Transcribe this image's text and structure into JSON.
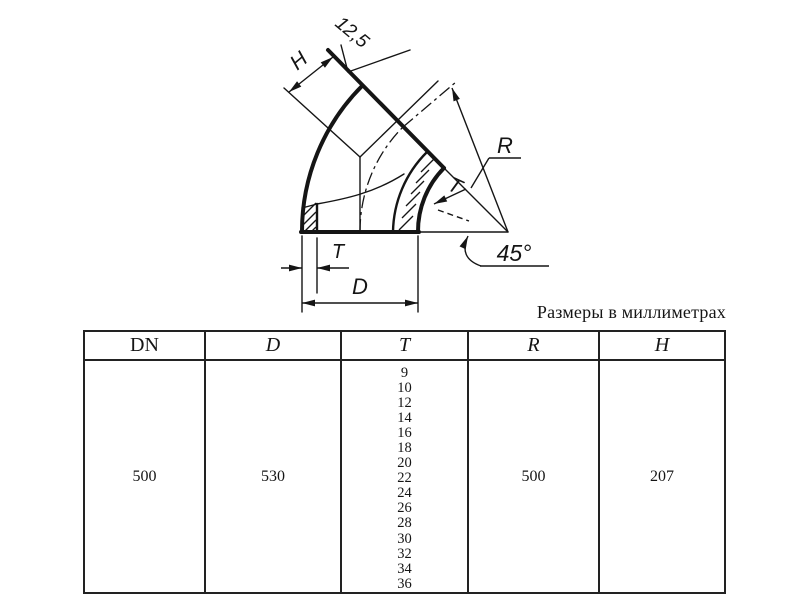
{
  "note": "Размеры в миллиметрах",
  "drawing": {
    "roughness_label": "12,5",
    "h_label": "H",
    "r_label": "R",
    "t_wall_label": "T",
    "t_bottom_label": "T",
    "d_label": "D",
    "angle_label": "45°"
  },
  "table": {
    "headers": [
      "DN",
      "D",
      "T",
      "R",
      "H"
    ],
    "row": {
      "dn": "500",
      "d": "530",
      "t_values": [
        "9",
        "10",
        "12",
        "14",
        "16",
        "18",
        "20",
        "22",
        "24",
        "26",
        "28",
        "30",
        "32",
        "34",
        "36"
      ],
      "r": "500",
      "h": "207"
    }
  }
}
